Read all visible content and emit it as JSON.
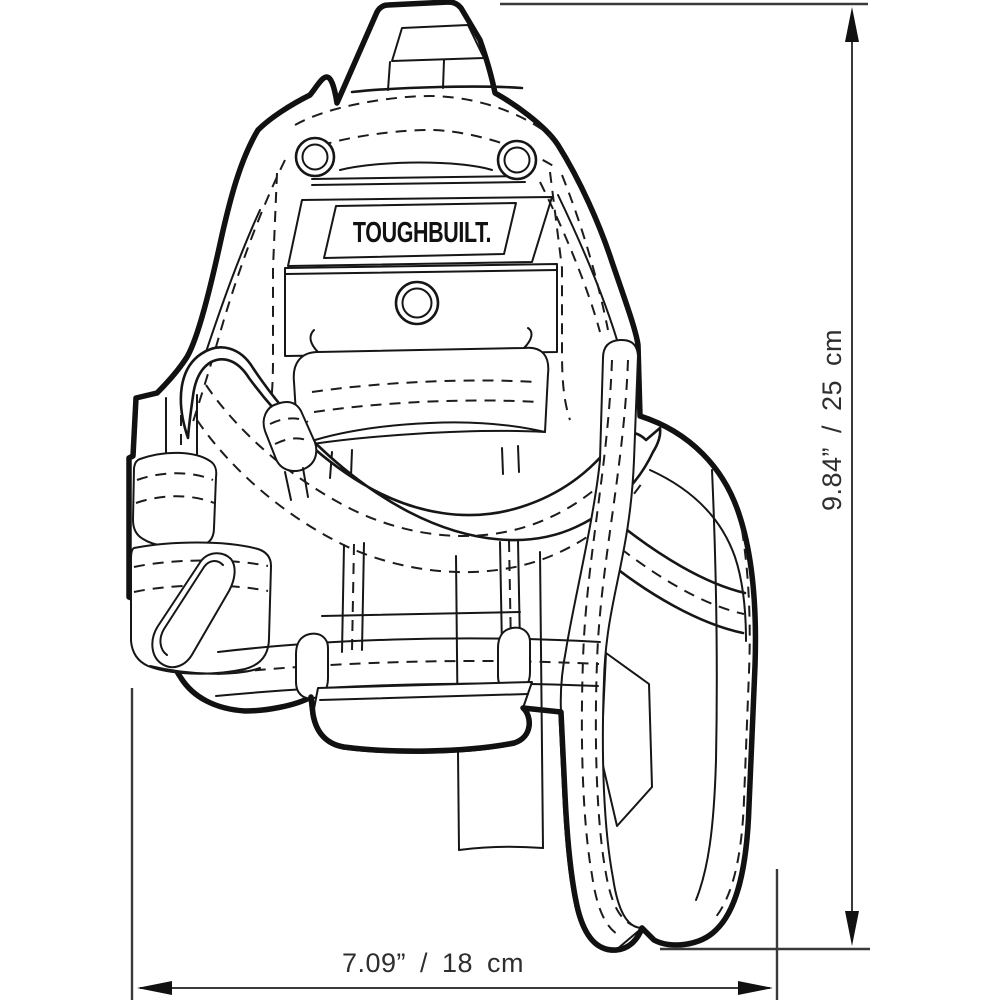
{
  "product": {
    "brand": "TOUGHBUILT."
  },
  "dimensions": {
    "height_label": "9.84” / 25 cm",
    "width_label": "7.09” / 18 cm"
  },
  "colors": {
    "background": "#ffffff",
    "line": "#161616",
    "dimension_line": "#3a3a3a",
    "text": "#2e2e2e"
  }
}
